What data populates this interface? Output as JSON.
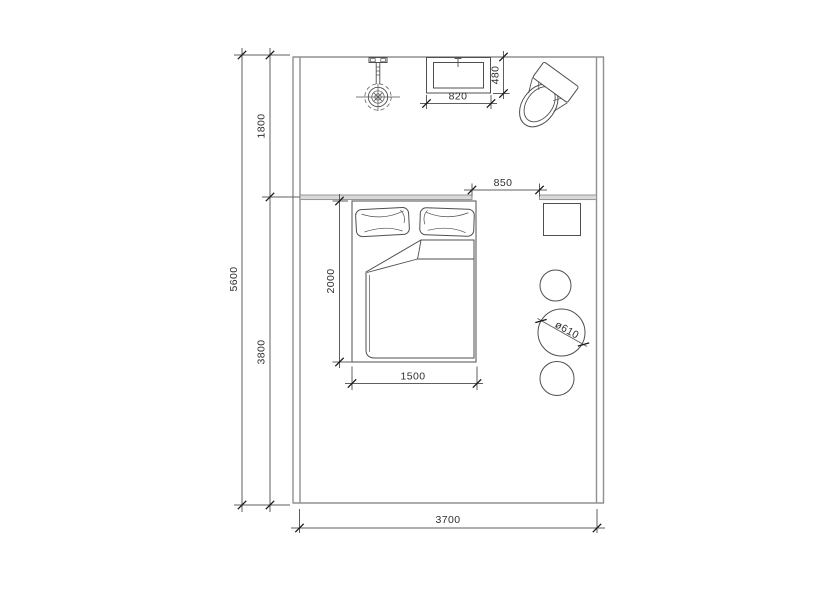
{
  "drawing": {
    "type": "architectural-floor-plan",
    "room": "bedroom-with-bathroom-zone",
    "units": "mm",
    "colors": {
      "background": "#ffffff",
      "wall_line": "#909090",
      "partition_fill": "#d9d9d9",
      "furniture_line": "#4f4f4f",
      "dimension_line": "#5f5f5f",
      "dimension_text": "#2f2f2f"
    }
  },
  "labels": {
    "total_depth": "5600",
    "bath_depth": "1800",
    "bedroom_depth": "3800",
    "room_width": "3700",
    "basin_width": "820",
    "basin_depth": "480",
    "opening_width": "850",
    "bed_length": "2000",
    "bed_width": "1500",
    "stool_diameter": "ø610"
  },
  "fixtures": [
    "ceiling-shower-head",
    "wash-basin",
    "toilet",
    "double-bed",
    "nightstand-square",
    "stool-small-upper",
    "stool-large-diameter-610",
    "stool-small-lower"
  ]
}
